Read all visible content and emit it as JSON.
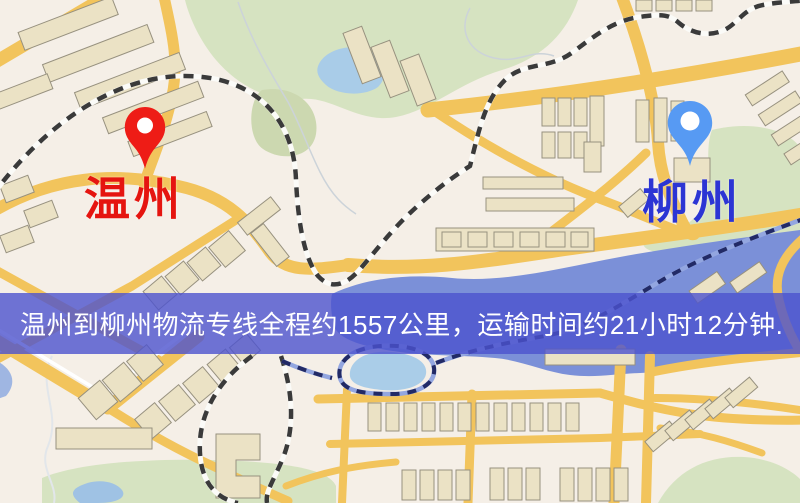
{
  "markers": {
    "origin": {
      "label": "温州",
      "text_color": "#e51510",
      "pin_color": "#ee1c16"
    },
    "destination": {
      "label": "柳州",
      "text_color": "#2c35d4",
      "pin_color": "#579af3"
    }
  },
  "banner": {
    "text": "温州到柳州物流专线全程约1557公里，运输时间约21小时12分钟.",
    "background": "#4c52ce",
    "text_color": "#ffffff"
  },
  "map": {
    "base_color": "#f5efe7",
    "road_color": "#f2c45c",
    "water_color": "#7b90d8",
    "lake_color": "#a9cce8",
    "park_color": "#d6e3c1",
    "building_color": "#ebe2c5",
    "building_outline": "#97917f",
    "railway_dash_color": "#3a3a3a"
  }
}
